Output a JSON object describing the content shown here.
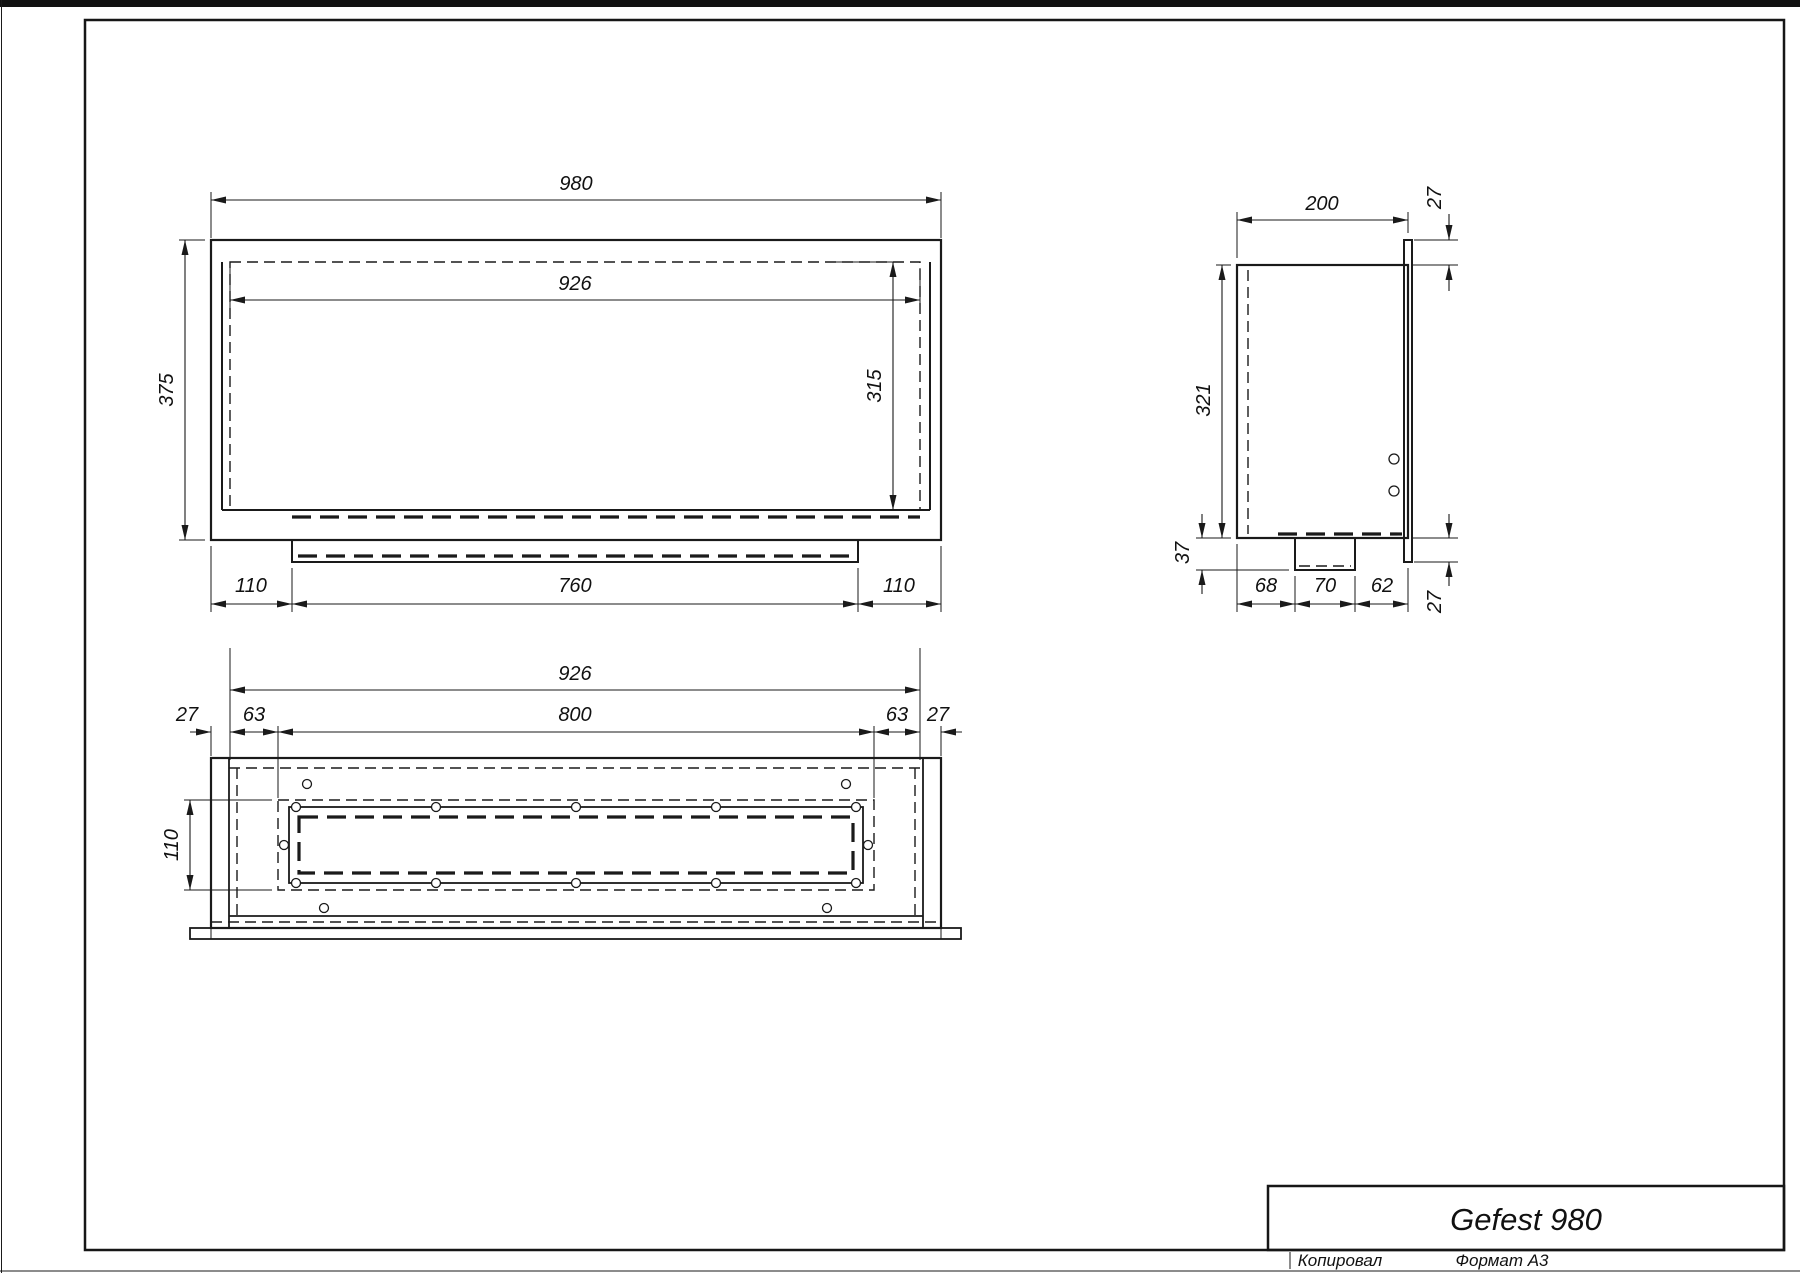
{
  "front_view": {
    "dims": {
      "overall_width": "980",
      "inner_width": "926",
      "overall_height": "375",
      "inner_height": "315",
      "bottom_left": "110",
      "bottom_center": "760",
      "bottom_right": "110"
    }
  },
  "side_view": {
    "dims": {
      "depth": "200",
      "flange_top": "27",
      "height": "321",
      "tray_drop": "37",
      "seg_front": "68",
      "seg_mid": "70",
      "seg_back": "62",
      "flange_bottom": "27"
    }
  },
  "plan_view": {
    "dims": {
      "inner_width": "926",
      "slot_length": "800",
      "edge_left": "27",
      "inset_left": "63",
      "inset_right": "63",
      "edge_right": "27",
      "slot_width": "110"
    }
  },
  "title_block": {
    "product_name": "Gefest 980",
    "copied_by_label": "Копировал",
    "format_label": "Формат A3"
  },
  "colors": {
    "line": "#1a1a1a",
    "background": "#ffffff"
  }
}
